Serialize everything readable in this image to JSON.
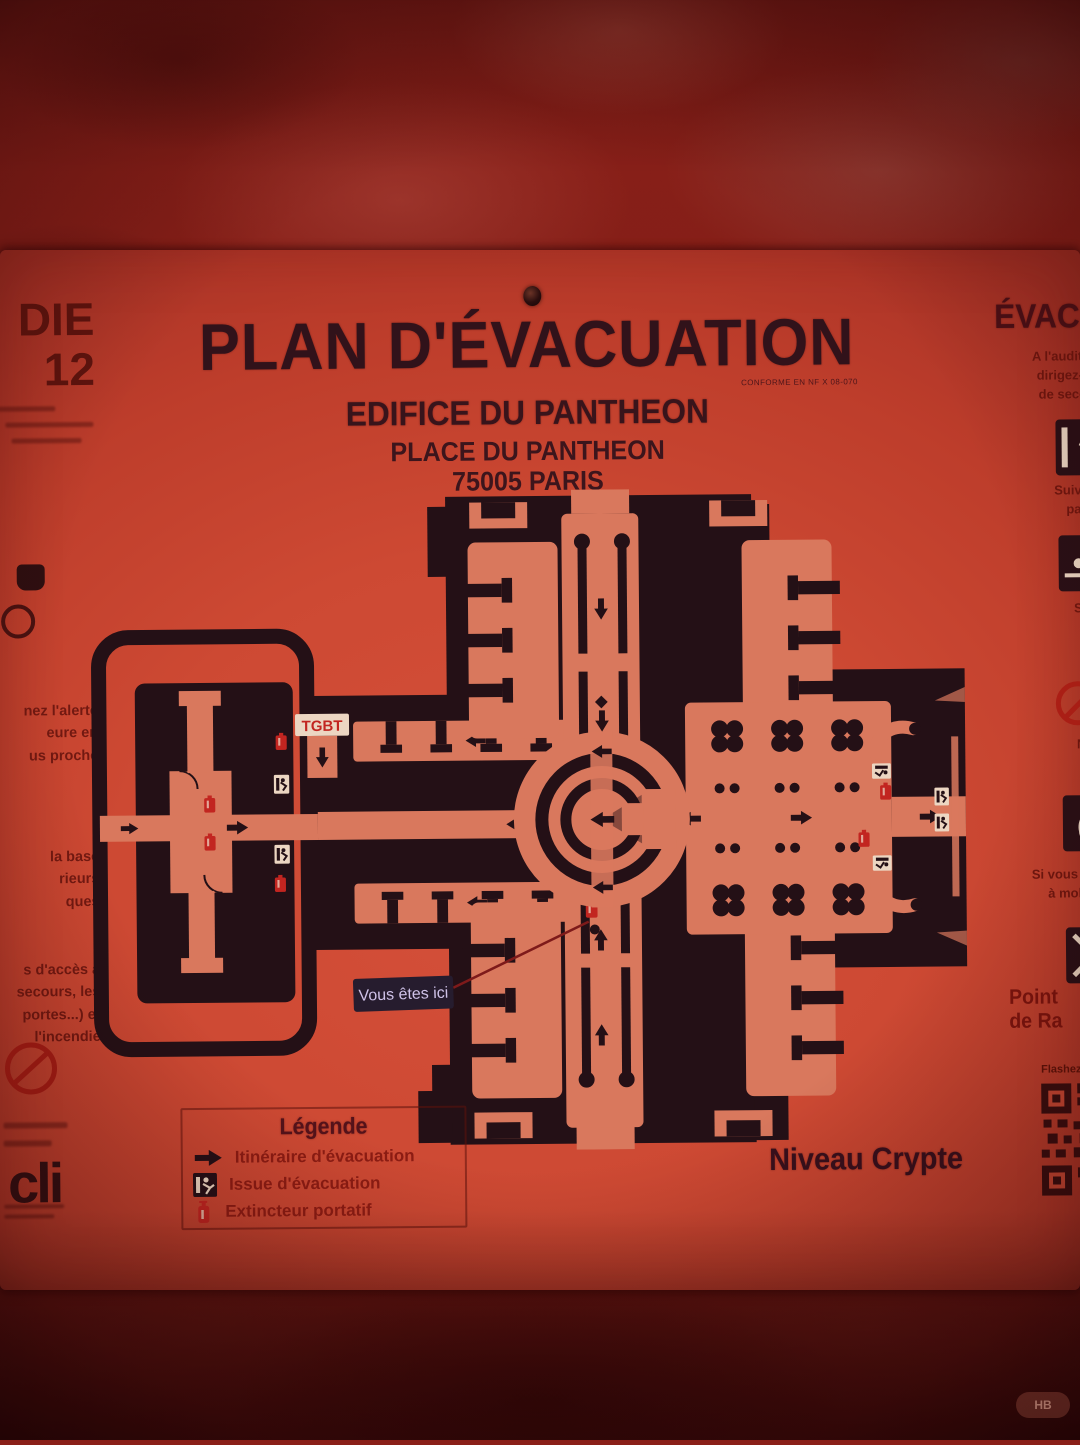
{
  "header": {
    "title": "PLAN D'ÉVACUATION",
    "conformity_note": "CONFORME EN NF X 08-070",
    "building": "EDIFICE DU PANTHEON",
    "address": "PLACE DU PANTHEON",
    "city": "75005 PARIS"
  },
  "map": {
    "level_label": "Niveau Crypte",
    "you_are_here_label": "Vous êtes ici",
    "tgbt_label": "TGBT"
  },
  "legend": {
    "title": "Légende",
    "items": [
      {
        "icon": "evacuation-route-arrow-icon",
        "label": "Itinéraire d'évacuation"
      },
      {
        "icon": "emergency-exit-icon",
        "label": "Issue d'évacuation"
      },
      {
        "icon": "fire-extinguisher-icon",
        "label": "Extincteur portatif"
      }
    ]
  },
  "left_column": {
    "big_fragments": [
      "DIE",
      "12"
    ],
    "groups": [
      [
        "nez l'alerte",
        "eure en",
        "us proche"
      ],
      [
        "la base",
        "rieurs",
        "ques"
      ],
      [
        "s d'accès à",
        "secours, les",
        "portes...) et",
        "l'incendie"
      ]
    ]
  },
  "right_column": {
    "heading": "ÉVACUATION",
    "paragraphs": [
      [
        "A l'audition du si",
        "dirigez-vous ve",
        "de secours sui"
      ],
      [
        "Suivez les inst",
        "par le guid"
      ],
      [
        "Si vous êtes",
        "la fumée,",
        "l'air frais"
      ],
      [
        "Ne revenez",
        "sans y av"
      ],
      [
        "Si vous le pouvez",
        "à mobilité ré"
      ]
    ],
    "assembly_point_label": "Point de Ra",
    "flash_label": "Flashez"
  },
  "footer": {
    "logo_text": "cli"
  },
  "watermark": {
    "text": "HB"
  },
  "colors": {
    "panel": "#cd4933",
    "ink": "#241016",
    "map_floor": "#d9785d",
    "accent_red": "#c22520",
    "sign_white": "#ecd6c2",
    "wall": "#7c1b14"
  }
}
